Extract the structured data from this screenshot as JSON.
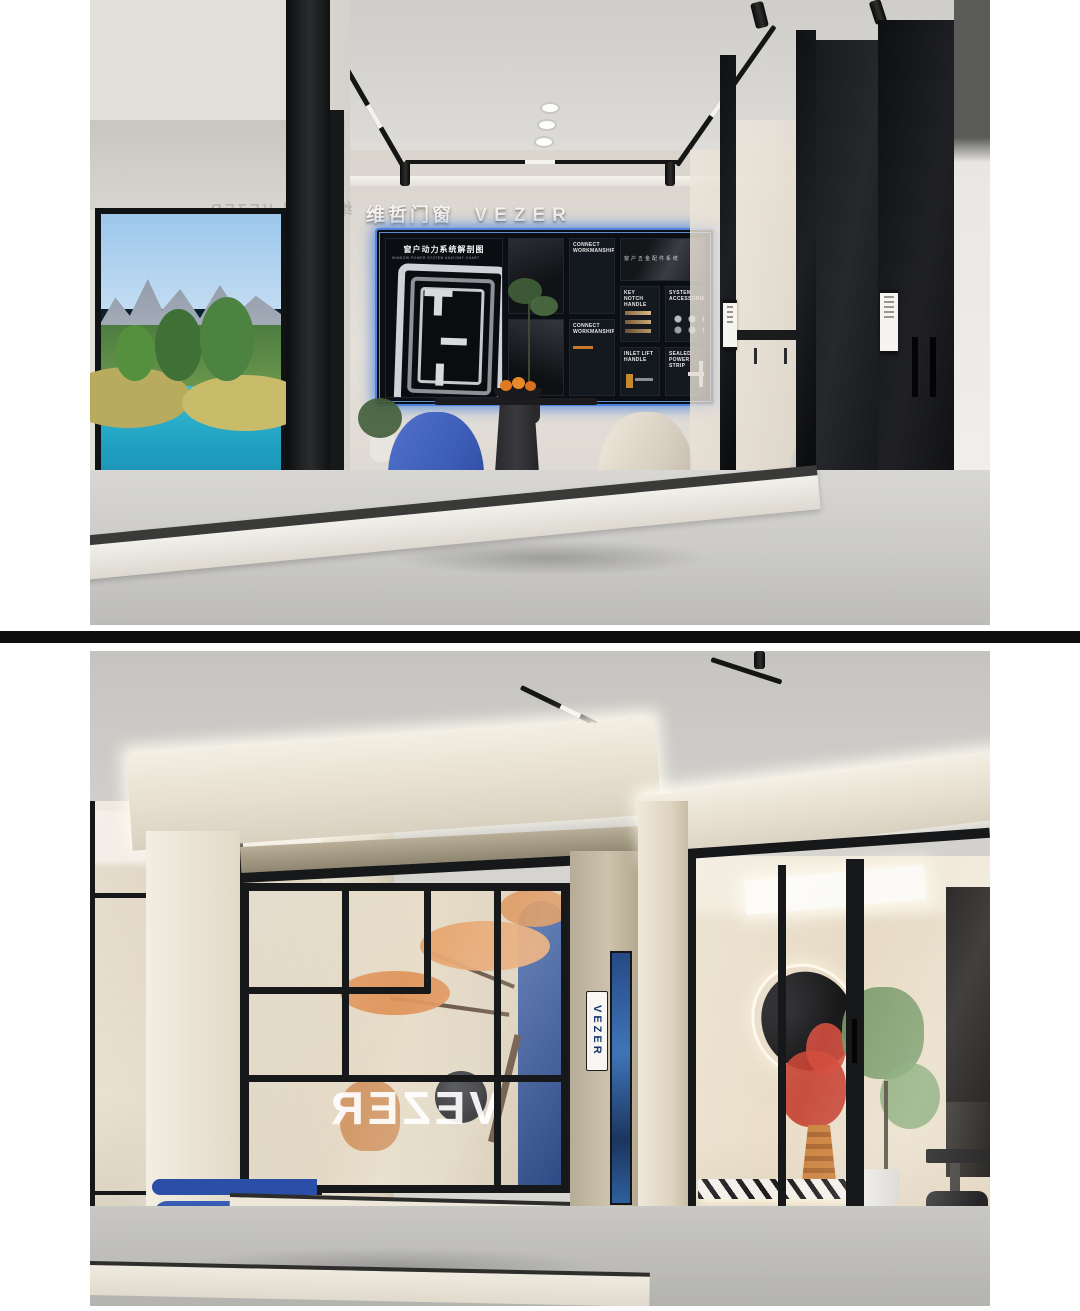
{
  "meta": {
    "layout": "two stacked interior renders of a VEZER door-and-window showroom separated by a black bar",
    "divider_color": "#0e0e0e",
    "background": "#ffffff"
  },
  "brand": {
    "cn": "维哲门窗",
    "en": "VEZER"
  },
  "top_photo": {
    "wall_sign": {
      "cn": "维哲门窗",
      "en": "VEZER"
    },
    "glass_reflection": {
      "cn": "维哲门窗",
      "en": "VEZER"
    },
    "display_board": {
      "title": "窗户动力系统解剖图",
      "subtitle": "WINDOW POWER SYSTEM ANATOMY CHART",
      "hardware_caption": "窗 户 五 金 配 件 系 统",
      "tiles": [
        {
          "label": "CONNECT\nWORKMANSHIP"
        },
        {
          "label": "CONNECT\nWORKMANSHIP"
        },
        {
          "label": "KEY NOTCH\nHANDLE"
        },
        {
          "label": "SYSTEM\nACCESSORIES"
        },
        {
          "label": "INLET LIFT\nHANDLE"
        },
        {
          "label": "SEALED\nPOWER STRIP"
        }
      ]
    }
  },
  "bottom_photo": {
    "vertical_sign": "VEZER",
    "glass_lettering": "VEZER"
  },
  "palette": {
    "accent_blue_glow": "#3f7bdc",
    "deep_blue": "#2b4ea6",
    "blue_chair": "#3d5eb8",
    "beige_chair": "#d8d0c2",
    "cream": "#e7e0d2",
    "board_bg": "#0b0e13",
    "water_turquoise": "#2fc4da",
    "bonsai_orange": "#dd8f52",
    "red_plant": "#c23828"
  }
}
